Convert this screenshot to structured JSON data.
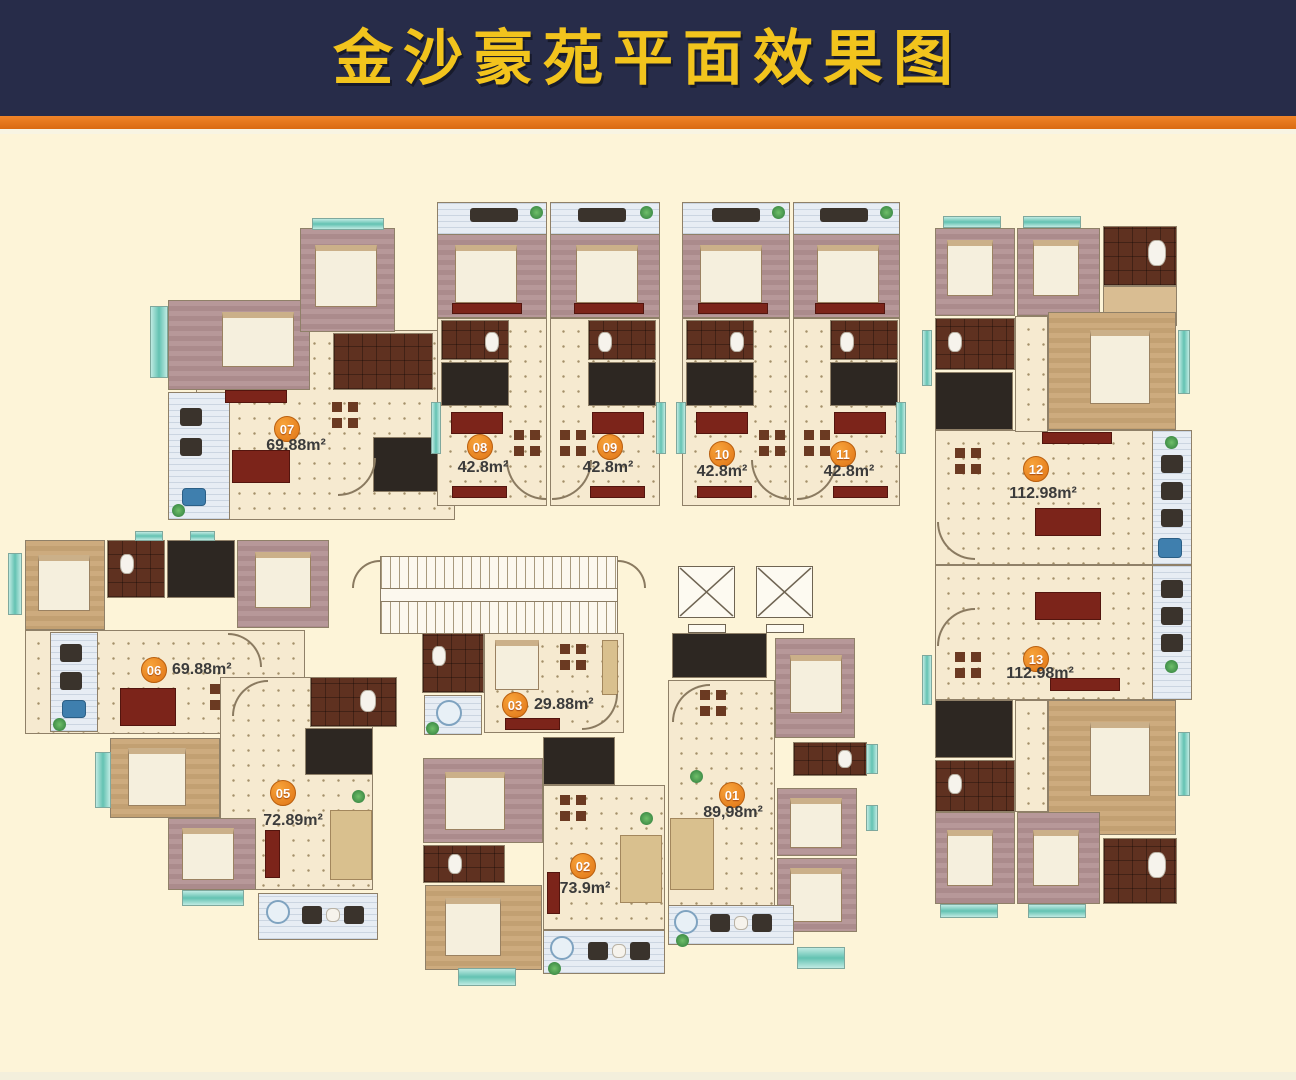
{
  "header": {
    "title": "金沙豪苑平面效果图"
  },
  "palette": {
    "header_bg": "#272c49",
    "title_color": "#f2c41d",
    "accent_stripe": "#e2751c",
    "background": "#fdf4d8",
    "badge": "#e8831e",
    "floor": "#f6ead0",
    "bedroom_mauve": "#b79899",
    "bedroom_tan": "#cdab7e",
    "bathroom": "#5f3120",
    "kitchen": "#2d2722",
    "balcony": "#e7edf4",
    "window_teal": "#63c2b2"
  },
  "units": [
    {
      "num": "01",
      "area": "89,98m²"
    },
    {
      "num": "02",
      "area": "73.9m²"
    },
    {
      "num": "03",
      "area": "29.88m²"
    },
    {
      "num": "05",
      "area": "72.89m²"
    },
    {
      "num": "06",
      "area": "69.88m²"
    },
    {
      "num": "07",
      "area": "69.88m²"
    },
    {
      "num": "08",
      "area": "42.8m²"
    },
    {
      "num": "09",
      "area": "42.8m²"
    },
    {
      "num": "10",
      "area": "42.8m²"
    },
    {
      "num": "11",
      "area": "42.8m²"
    },
    {
      "num": "12",
      "area": "112.98m²"
    },
    {
      "num": "13",
      "area": "112.98m²"
    }
  ]
}
